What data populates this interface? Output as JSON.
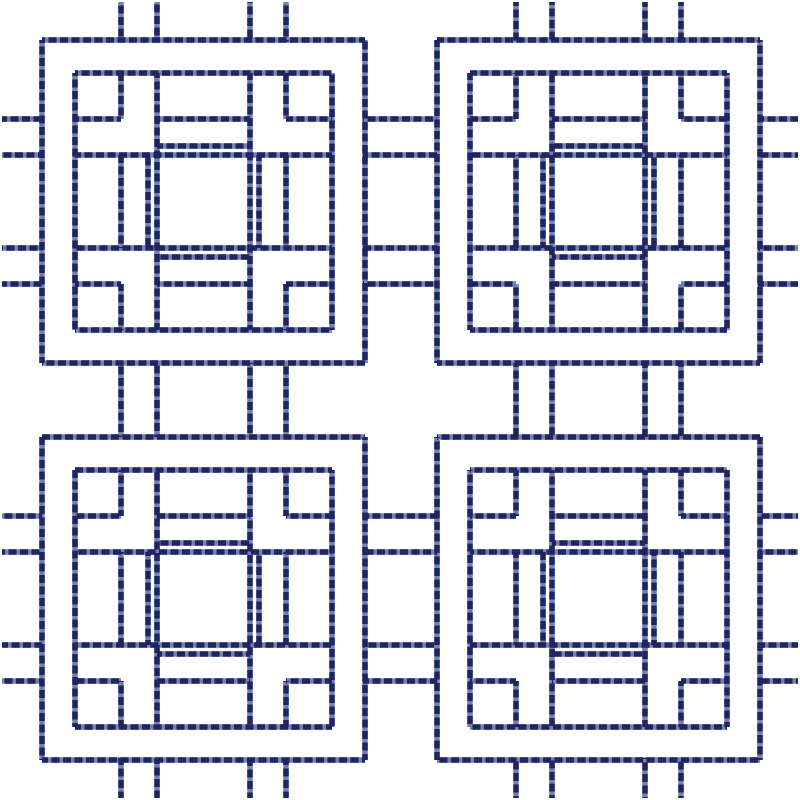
{
  "canvas": {
    "width": 800,
    "height": 800,
    "background": "#ffffff"
  },
  "stitch_style": {
    "thread_dark": "#1d2563",
    "thread_light": "#7680af",
    "stroke_width": 5.5,
    "dash_length": 8,
    "dash_gap": 3.5
  },
  "pattern": {
    "description": "2x2 grid of square lattice quilting motifs stitched in navy dashed thread, joined by ladder rails and edge ticks",
    "motif_size": 323,
    "motif_origins": [
      [
        42,
        40
      ],
      [
        437,
        40
      ],
      [
        42,
        437
      ],
      [
        437,
        437
      ]
    ],
    "motif_h_segments": [
      [
        0,
        0,
        323
      ],
      [
        323,
        0,
        323
      ],
      [
        33,
        33,
        290
      ],
      [
        290,
        33,
        290
      ],
      [
        79,
        33,
        79
      ],
      [
        79,
        244,
        290
      ],
      [
        79,
        115,
        208
      ],
      [
        106,
        115,
        208
      ],
      [
        115,
        33,
        290
      ],
      [
        208,
        33,
        290
      ],
      [
        217,
        115,
        208
      ],
      [
        244,
        115,
        208
      ],
      [
        244,
        33,
        79
      ],
      [
        244,
        244,
        290
      ]
    ],
    "motif_v_segments": [
      [
        0,
        0,
        323
      ],
      [
        323,
        0,
        323
      ],
      [
        33,
        33,
        290
      ],
      [
        290,
        33,
        290
      ],
      [
        79,
        33,
        79
      ],
      [
        79,
        244,
        290
      ],
      [
        79,
        115,
        208
      ],
      [
        106,
        115,
        208
      ],
      [
        115,
        33,
        290
      ],
      [
        208,
        33,
        290
      ],
      [
        217,
        115,
        208
      ],
      [
        244,
        115,
        208
      ],
      [
        244,
        33,
        79
      ],
      [
        244,
        244,
        290
      ]
    ],
    "rail_y": [
      119,
      155,
      248,
      284,
      516,
      552,
      645,
      681
    ],
    "rail_x": [
      121,
      157,
      250,
      286,
      516,
      552,
      645,
      681
    ],
    "rail_spans": [
      [
        2,
        42
      ],
      [
        363,
        437
      ],
      [
        758,
        798
      ]
    ]
  }
}
